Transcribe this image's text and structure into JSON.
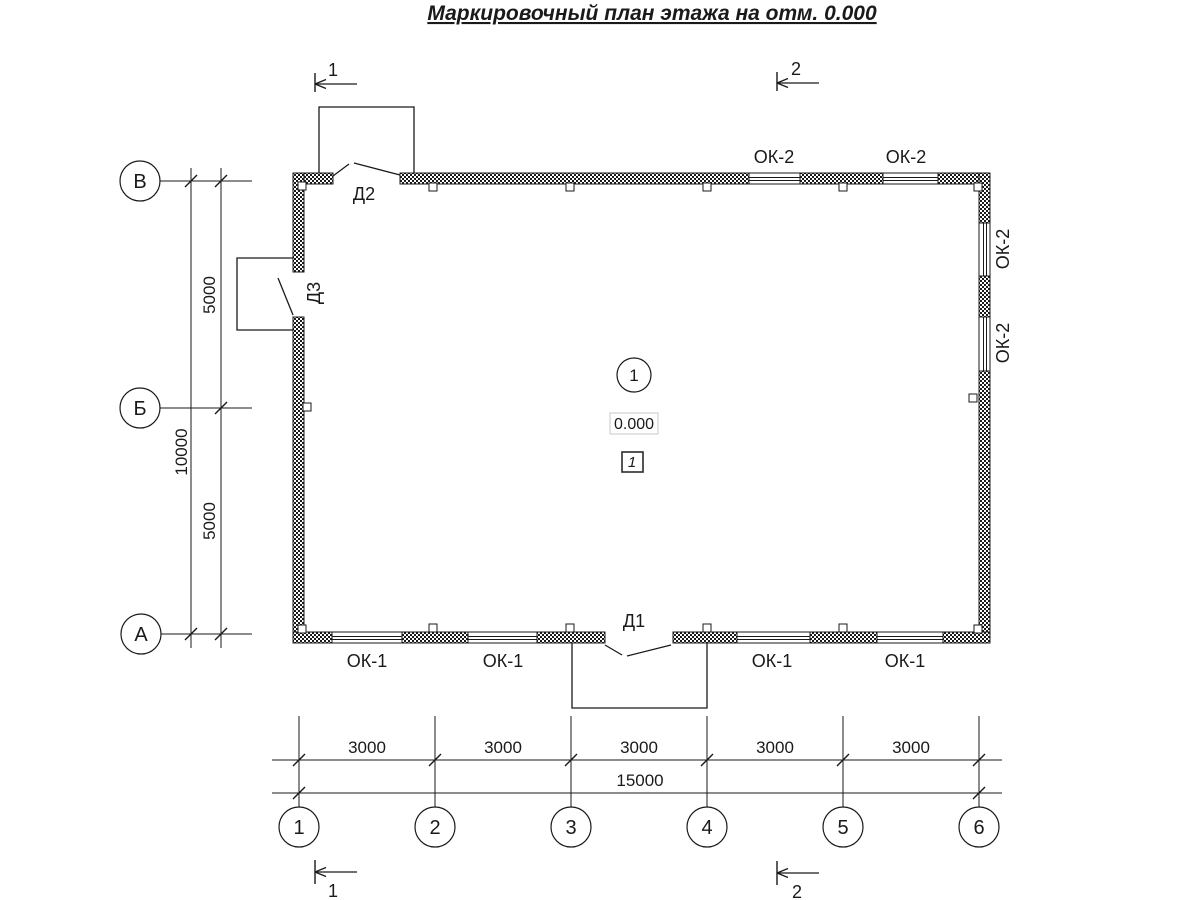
{
  "title": "Маркировочный план этажа на отм. 0.000",
  "section_marks": {
    "top_1": "1",
    "top_2": "2",
    "bottom_1": "1",
    "bottom_2": "2"
  },
  "row_axes": [
    {
      "label": "В"
    },
    {
      "label": "Б"
    },
    {
      "label": "А"
    }
  ],
  "col_axes": [
    {
      "label": "1"
    },
    {
      "label": "2"
    },
    {
      "label": "3"
    },
    {
      "label": "4"
    },
    {
      "label": "5"
    },
    {
      "label": "6"
    }
  ],
  "dims_left": {
    "upper": "5000",
    "total": "10000",
    "lower": "5000"
  },
  "dims_bottom": {
    "segments": [
      "3000",
      "3000",
      "3000",
      "3000",
      "3000"
    ],
    "total": "15000"
  },
  "window_labels": {
    "top": [
      "ОК-2",
      "ОК-2"
    ],
    "right": [
      "ОК-2",
      "ОК-2"
    ],
    "bottom": [
      "ОК-1",
      "ОК-1",
      "ОК-1",
      "ОК-1"
    ]
  },
  "door_labels": {
    "d2": "Д2",
    "d3": "Д3",
    "d1": "Д1"
  },
  "room": {
    "axis_ref": "1",
    "elevation": "0.000",
    "room_no": "1"
  }
}
